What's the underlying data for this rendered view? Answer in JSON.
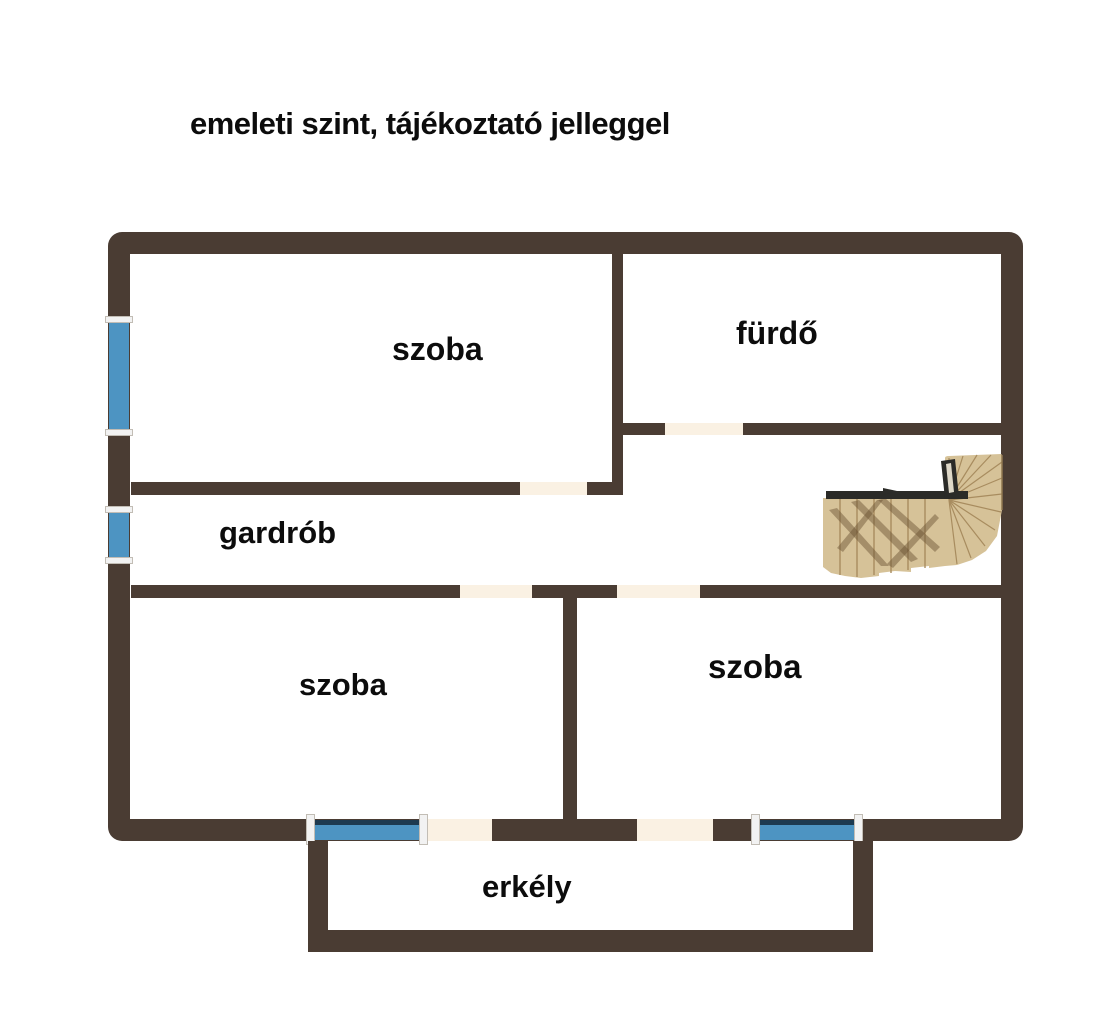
{
  "title": "emeleti szint, tájékoztató jelleggel",
  "labels": {
    "room_top": "szoba",
    "bathroom": "fürdő",
    "wardrobe": "gardrób",
    "room_bottom_left": "szoba",
    "room_bottom_right": "szoba",
    "balcony": "erkély"
  },
  "colors": {
    "wall": "#4a3c33",
    "window_blue": "#4d94c2",
    "window_frame_dark": "#1d3a50",
    "opening_cream": "#faf1e3",
    "jamb_white": "#f2f2f2",
    "stair_wood": "#d6c298",
    "stair_wood_dark": "#a88c5f",
    "stair_rail": "#2b2b28",
    "text": "#0c0c0c",
    "background": "#ffffff"
  }
}
